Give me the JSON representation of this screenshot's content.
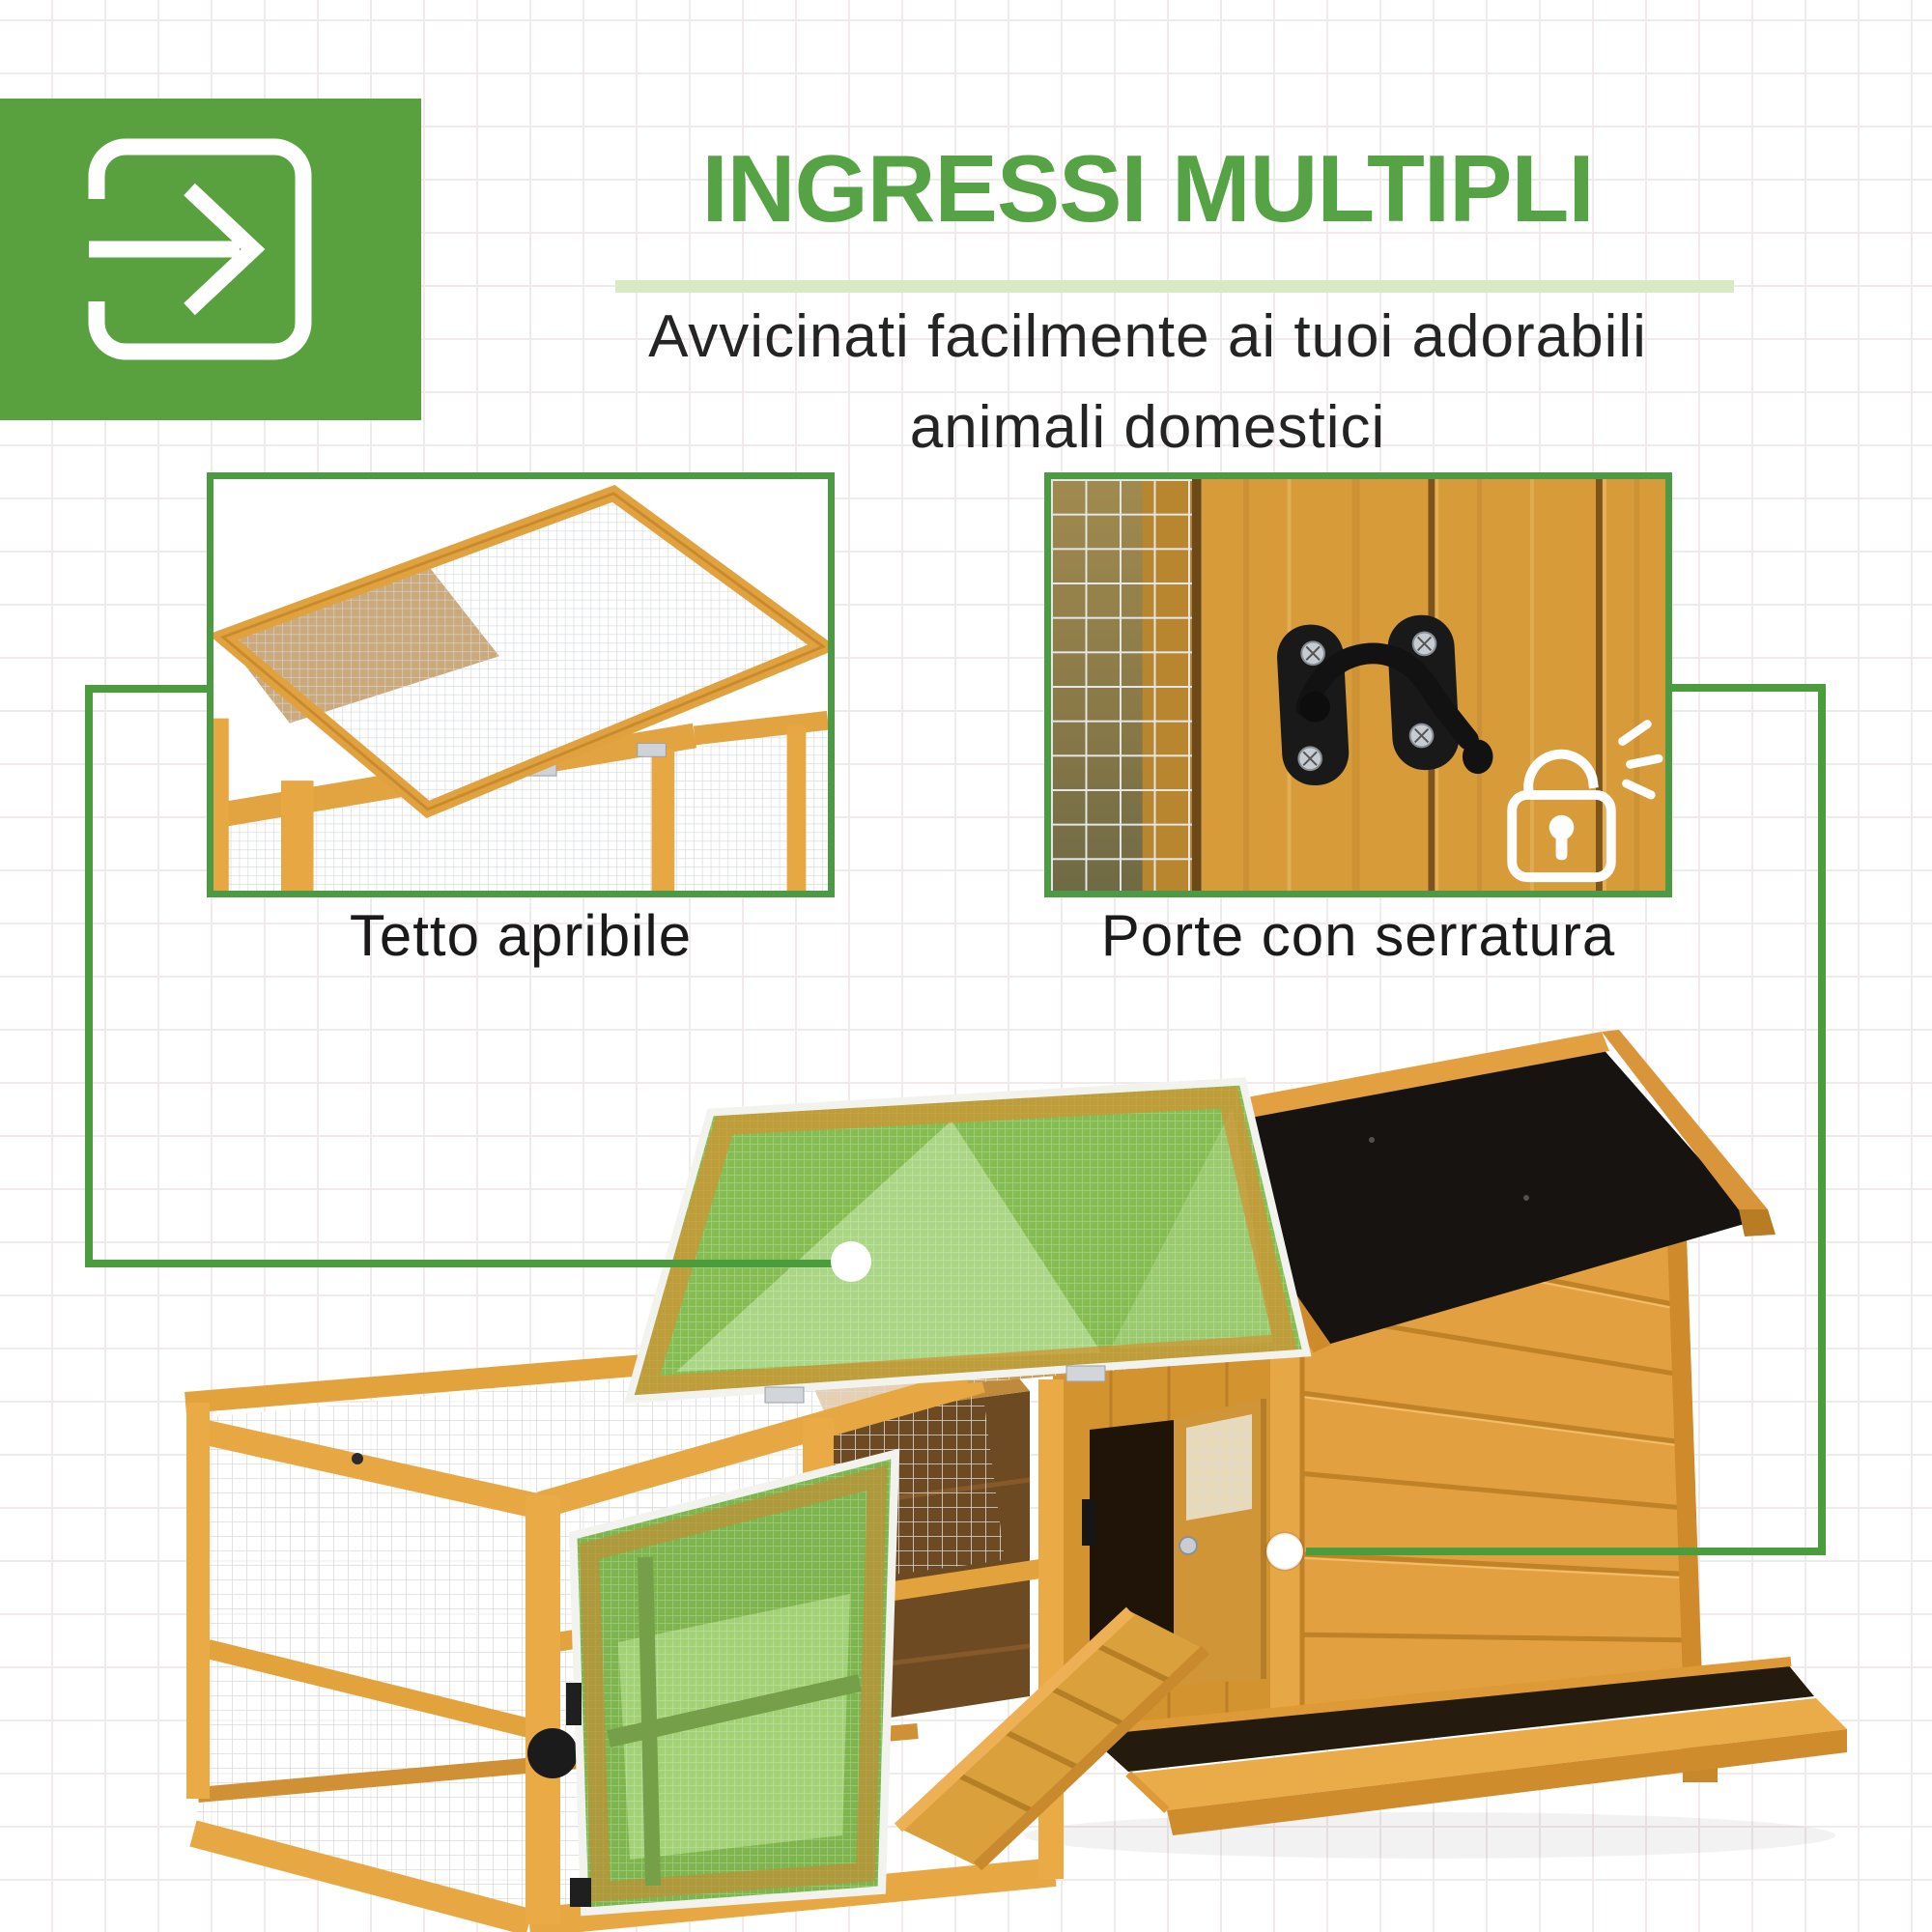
{
  "header": {
    "title": "INGRESSI MULTIPLI",
    "subtitle_line1": "Avvicinati facilmente ai tuoi adorabili",
    "subtitle_line2": "animali domestici"
  },
  "features": {
    "roof": {
      "caption": "Tetto apribile"
    },
    "lock": {
      "caption": "Porte con serratura"
    }
  },
  "icons": {
    "badge": "enter-arrow-icon",
    "lock_overlay": "open-padlock-icon",
    "markers": [
      "roof-marker-dot",
      "door-marker-dot"
    ]
  },
  "colors": {
    "accent_green": "#4c9a44",
    "title_green": "#55a344",
    "icon_block_green": "#59a13f",
    "underline_bar": "#d8e9c6",
    "connector_green": "#4a9c3c",
    "highlight_overlay": "#86bd52",
    "wood_orange": "#e2a23c",
    "roof_black": "#171310",
    "text_dark": "#1a1a1a"
  }
}
